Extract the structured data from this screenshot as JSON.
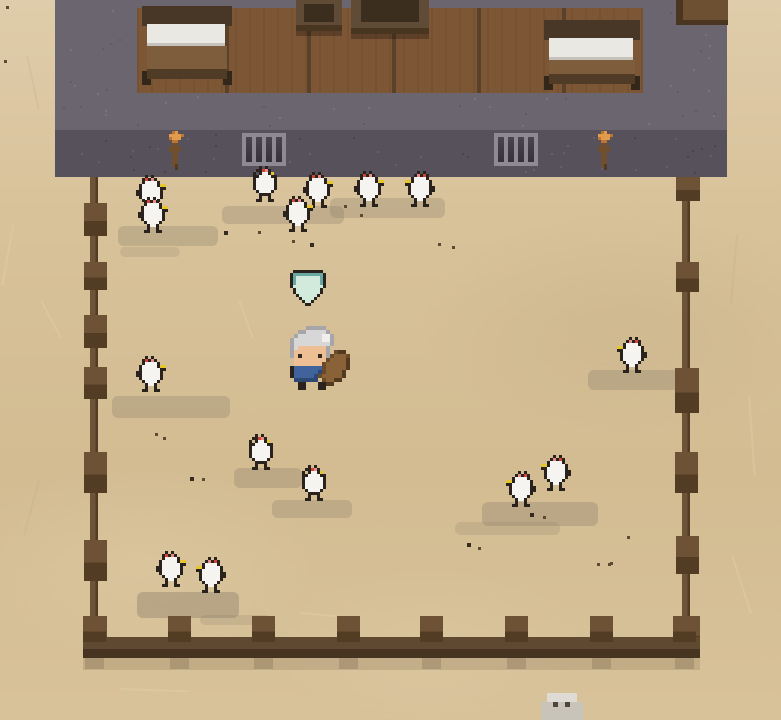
{
  "meta": {
    "width": 781,
    "height": 720,
    "scene_kind": "pixel-art chicken pen outside a wooden ranch house"
  },
  "palette": {
    "K": "#2a231d",
    "W": "#f5f4f0",
    "R": "#d14538",
    "P": "#e78b8b",
    "Y": "#e6c52e",
    "T": "#69a8a1",
    "M": "#d2ead b",
    "O": "#e29a4b",
    "o": "#bd7532",
    "d": "#6f4f2e",
    "s": "#523a21",
    "G": "#d7d7d7",
    "g": "#a6a5a9",
    "w": "#f0efec",
    "F": "#eebf94",
    "E": "#362b23",
    "B": "#41639b",
    "b": "#2d4873",
    "S": "#8a6238",
    "t": "#6b4a29"
  },
  "colors": {
    "ground": "#d8c29a",
    "ground_hi": "#dfccaa",
    "ground_lo": "#d3bc92",
    "stone_upper": "#6b6570",
    "stone_band": "#56515b",
    "speckle_up_light": "#79737d",
    "speckle_up_dark": "#5f5a66",
    "speckle_band_light": "#655f6b",
    "speckle_band_dark": "#49444f",
    "wood": "#7d5635",
    "plank": "#5a4129",
    "bed_head": "#483627",
    "bed_sheet": "#e9e8e3",
    "bed_sheet_shadow": "#c4c2bb",
    "bed_frame": "#7d5d3b",
    "bed_foot": "#503b26",
    "bed_leg": "#33271a",
    "furn_body": "#604b36",
    "furn_inner": "#3c2e1f",
    "furn_band": "#483621",
    "cabinet": "#6d4f31",
    "cabinet_edge": "#4a3520",
    "window_frame": "#8e8992",
    "window_dark_top": "#4a4450",
    "window_dark_bot": "#35313a",
    "post_top": "#6d5236",
    "post_bot": "#533c24",
    "rail": "#6d5338",
    "brail_top": "#5f4930",
    "brail_bot": "#463420",
    "fence_shadow": "rgba(122,102,75,0.30)",
    "patch": "#8c7f6b",
    "debris_dark": "#5d4a33",
    "debris_darker": "#362b1f",
    "crack_light": "#efe0bb",
    "crack_dark": "#bfa87f",
    "rock_cap": "#dedbd4",
    "rock_body": "#c9c4b9",
    "rock_eye": "#4c463e",
    "marker_fill": "#d2eadb",
    "marker_rim": "#69a8a1"
  },
  "sprites": {
    "chicken_right": [
      "...K.K.....",
      "..KRKPK....",
      "..KWWWWK...",
      ".KWWWWWKYY.",
      ".KWWWWWWKK.",
      "KKWWWWWWK..",
      "KKWWWWWWK..",
      ".KWWWWWWK..",
      "..KWWWWK...",
      "...KWWK....",
      "...K..K....",
      "..KK..KK..."
    ],
    "chicken_front": [
      "...K.K.....",
      "..KKRPK....",
      ".K.KWWKY...",
      ".KKWWWWKK..",
      ".KWWWWWWK..",
      ".KWWWWWWK..",
      ".KWWWWWWK..",
      ".KWWWWWWK..",
      "..KWWWWK...",
      "...KKKK....",
      "...K..K....",
      "..KK..KK..."
    ],
    "quest_marker": [
      ".KKKKKKKKKK.",
      "KTTTTTTTTTTK",
      "KTMMMMMMMMTK",
      "KTMMMMMMMMTK",
      "KTMMMMMMMMTK",
      "KMMMMMMMMMMK",
      ".KMMMMMMMMK.",
      ".KMMMMMMMMK.",
      "..KMMMMMMK..",
      "...KMMMMK...",
      "....KMMK....",
      ".....KK....."
    ],
    "player": [
      "......ggggg.......",
      "....ggGGGGGg......",
      "...gGGGGGGwwg.....",
      "..gGGGGGGGwwg.....",
      "..gGGGGGGGGGg.....",
      "..gGFFFFFFFg......",
      "..gFFFFFFFFg.tss..",
      "..gFEFFFFEFgtSSSt.",
      "...FFFFFFFFtSSSSs.",
      "...FFFFFFFtSSSSSs.",
      "..KBBBBBBBtSSSSSs.",
      "..KBBBBBBbtSSSSs..",
      "..KBBBBBbtSSSSSs..",
      "...bbbbbb.tSSss...",
      "....KK...KKss.....",
      "....KK...KK......."
    ],
    "torch": [
      "...oO....",
      "..OOOOo..",
      "..oOOO...",
      "...oo....",
      "...dd....",
      "..dddd...",
      "..dddd...",
      "...dd....",
      "...dd....",
      "...dd....",
      "...dd....",
      "...ds....",
      "....s...."
    ]
  },
  "scene": {
    "stone": {
      "x": 55,
      "w": 672,
      "upper_y": 0,
      "upper_h": 130,
      "band_y": 130,
      "band_h": 47
    },
    "interior": {
      "x": 137,
      "y": 8,
      "w": 506,
      "h": 85,
      "plank_lines": [
        225,
        307,
        392,
        477,
        562
      ]
    },
    "beds": [
      {
        "x": 142,
        "y": 6,
        "w": 90,
        "h": 79
      },
      {
        "x": 544,
        "y": 20,
        "w": 96,
        "h": 70
      }
    ],
    "furniture": [
      {
        "kind": "chair",
        "x": 296,
        "y": 0,
        "w": 46,
        "h": 31,
        "ix": 8,
        "iy": 4,
        "iw": 30,
        "ih": 18
      },
      {
        "kind": "table",
        "x": 351,
        "y": 0,
        "w": 78,
        "h": 34,
        "ix": 10,
        "iy": 0,
        "iw": 58,
        "ih": 22
      }
    ],
    "cabinet": {
      "x": 676,
      "y": 0,
      "w": 52,
      "h": 25
    },
    "windows": [
      {
        "x": 242,
        "y": 133
      },
      {
        "x": 494,
        "y": 133
      }
    ],
    "window_size": {
      "w": 44,
      "h": 33,
      "frame": 4,
      "bars": 3,
      "bar_w": 4
    },
    "torches": [
      {
        "x": 163,
        "y": 131
      },
      {
        "x": 592,
        "y": 131
      }
    ],
    "fence": {
      "left": {
        "rail": [
          90,
          177,
          8,
          472
        ],
        "posts": [
          [
            84,
            203,
            23,
            33
          ],
          [
            84,
            262,
            23,
            28
          ],
          [
            84,
            315,
            23,
            33
          ],
          [
            84,
            367,
            23,
            32
          ],
          [
            84,
            452,
            23,
            41
          ],
          [
            84,
            540,
            23,
            41
          ],
          [
            83,
            616,
            24,
            36
          ]
        ]
      },
      "right": {
        "rail": [
          682,
          198,
          8,
          451
        ],
        "posts": [
          [
            676,
            177,
            24,
            24
          ],
          [
            676,
            262,
            23,
            30
          ],
          [
            675,
            368,
            24,
            45
          ],
          [
            675,
            452,
            23,
            41
          ],
          [
            676,
            536,
            23,
            38
          ],
          [
            674,
            616,
            26,
            36
          ]
        ]
      },
      "bottom": {
        "rail_top": [
          83,
          637,
          617,
          12
        ],
        "rail_bot": [
          83,
          649,
          617,
          9
        ],
        "posts_x": [
          83,
          168,
          252,
          337,
          420,
          505,
          590,
          673
        ],
        "post_y": 616,
        "post_w": 23,
        "post_h": 26,
        "shadow_band": [
          83,
          658,
          617,
          12
        ]
      }
    },
    "patches": [
      [
        118,
        226,
        100,
        20,
        0.32
      ],
      [
        222,
        206,
        122,
        18,
        0.3
      ],
      [
        330,
        198,
        115,
        20,
        0.3
      ],
      [
        112,
        396,
        118,
        22,
        0.32
      ],
      [
        588,
        370,
        92,
        20,
        0.33
      ],
      [
        234,
        468,
        68,
        20,
        0.32
      ],
      [
        272,
        500,
        80,
        18,
        0.3
      ],
      [
        482,
        502,
        116,
        24,
        0.34
      ],
      [
        137,
        592,
        102,
        26,
        0.42
      ],
      [
        455,
        522,
        105,
        13,
        0.22
      ],
      [
        120,
        247,
        60,
        10,
        0.2
      ],
      [
        200,
        615,
        70,
        10,
        0.22
      ]
    ],
    "debris": [
      [
        224,
        231,
        4
      ],
      [
        258,
        231,
        3
      ],
      [
        292,
        240,
        3
      ],
      [
        310,
        243,
        4
      ],
      [
        438,
        243,
        3
      ],
      [
        452,
        246,
        3
      ],
      [
        155,
        433,
        3
      ],
      [
        163,
        437,
        3
      ],
      [
        190,
        477,
        4
      ],
      [
        202,
        478,
        3
      ],
      [
        467,
        543,
        4
      ],
      [
        478,
        547,
        3
      ],
      [
        627,
        536,
        3
      ],
      [
        610,
        562,
        3
      ],
      [
        597,
        563,
        3
      ],
      [
        608,
        563,
        3
      ],
      [
        530,
        513,
        4
      ],
      [
        543,
        516,
        3
      ],
      [
        344,
        205,
        3
      ],
      [
        360,
        214,
        3
      ],
      [
        6,
        6,
        3
      ],
      [
        4,
        60,
        3
      ]
    ],
    "cracks": [
      [
        28,
        55,
        55,
        78
      ],
      [
        14,
        225,
        62,
        100
      ],
      [
        42,
        300,
        42,
        62
      ],
      [
        738,
        235,
        70,
        95
      ],
      [
        750,
        395,
        82,
        86
      ],
      [
        733,
        555,
        62,
        72
      ],
      [
        40,
        480,
        58,
        105
      ],
      [
        120,
        688,
        70,
        2
      ],
      [
        300,
        612,
        55,
        5
      ],
      [
        430,
        95,
        0,
        0
      ],
      [
        455,
        640,
        48,
        2
      ],
      [
        240,
        300,
        40,
        70
      ]
    ],
    "entities": [
      {
        "type": "chicken",
        "facing": "right",
        "x": 136,
        "y": 175
      },
      {
        "type": "chicken",
        "facing": "right",
        "x": 138,
        "y": 197
      },
      {
        "type": "chicken",
        "facing": "front",
        "x": 250,
        "y": 166
      },
      {
        "type": "chicken",
        "facing": "right",
        "x": 283,
        "y": 196
      },
      {
        "type": "chicken",
        "facing": "right",
        "x": 303,
        "y": 172
      },
      {
        "type": "chicken",
        "facing": "right",
        "x": 354,
        "y": 171
      },
      {
        "type": "chicken",
        "facing": "left",
        "x": 402,
        "y": 171
      },
      {
        "type": "chicken",
        "facing": "right",
        "x": 136,
        "y": 356
      },
      {
        "type": "chicken",
        "facing": "left",
        "x": 614,
        "y": 337
      },
      {
        "type": "chicken",
        "facing": "front",
        "x": 246,
        "y": 434
      },
      {
        "type": "chicken",
        "facing": "front",
        "x": 299,
        "y": 465
      },
      {
        "type": "chicken",
        "facing": "left",
        "x": 503,
        "y": 471
      },
      {
        "type": "chicken",
        "facing": "left",
        "x": 538,
        "y": 455
      },
      {
        "type": "chicken",
        "facing": "right",
        "x": 156,
        "y": 551
      },
      {
        "type": "chicken",
        "facing": "left",
        "x": 193,
        "y": 557
      },
      {
        "type": "player",
        "x": 282,
        "y": 326
      },
      {
        "type": "marker",
        "x": 290,
        "y": 270
      },
      {
        "type": "rock",
        "x": 541,
        "y": 693
      }
    ]
  }
}
